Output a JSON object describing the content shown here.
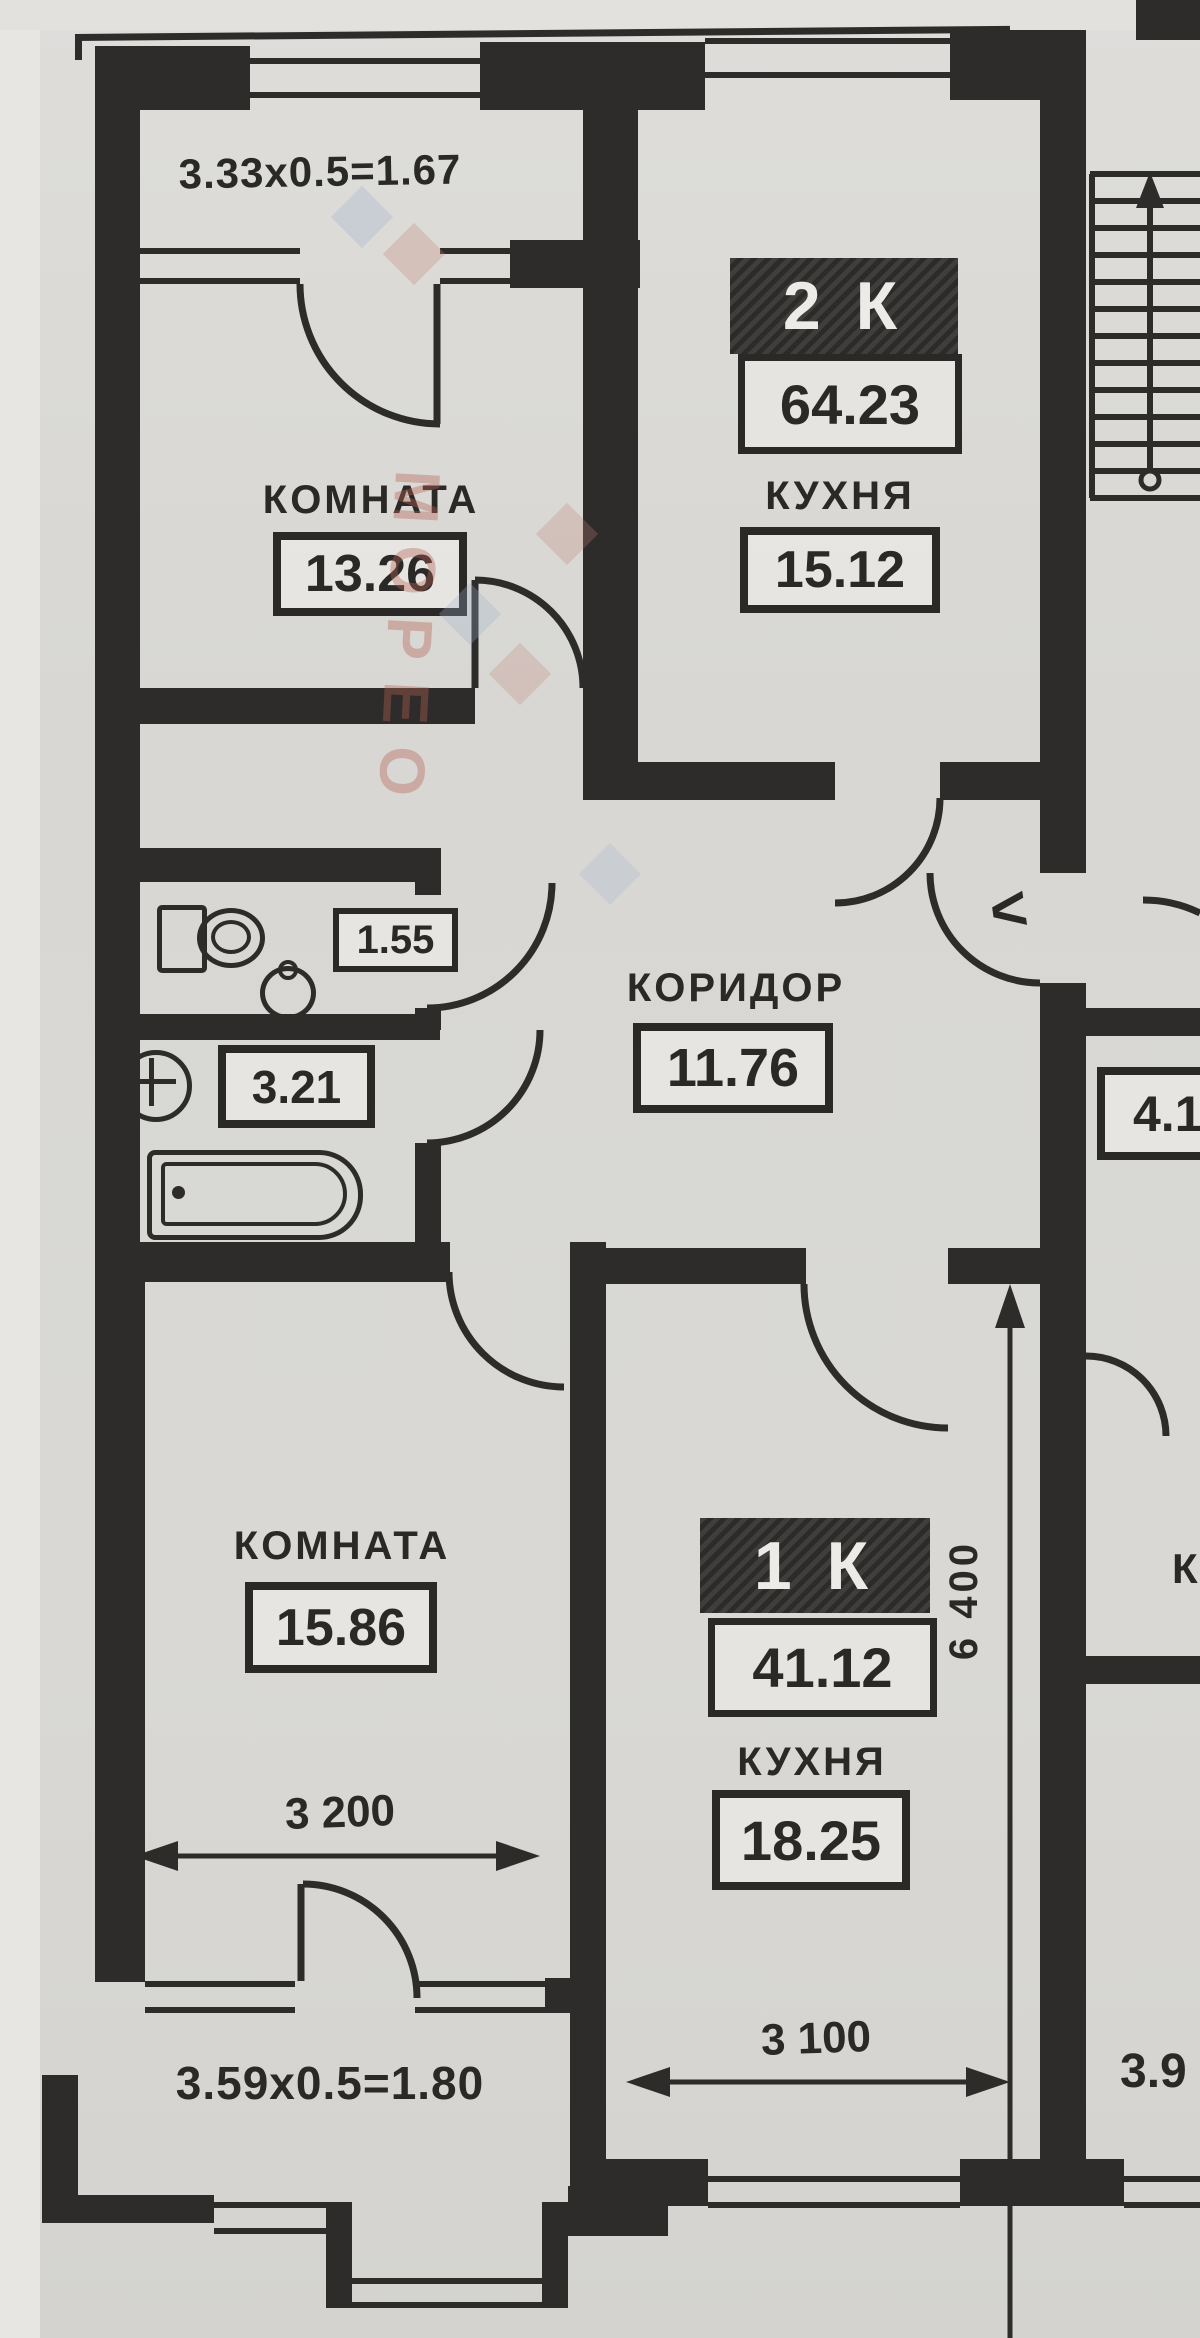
{
  "plan": {
    "watermark": {
      "text": "МОРЕО"
    },
    "colors": {
      "paper": "#d9d8d4",
      "wall": "#2e2c2a",
      "watermark_pink": "#c08376",
      "watermark_blue": "#9fafcc"
    },
    "units": {
      "unit_2k": {
        "badge": "2 К",
        "total_area": "64.23"
      },
      "unit_1k": {
        "badge": "1 К",
        "total_area": "41.12"
      }
    },
    "rooms": {
      "room_top": {
        "label": "КОМНАТА",
        "area": "13.26"
      },
      "kitchen_top": {
        "label": "КУХНЯ",
        "area": "15.12"
      },
      "corridor": {
        "label": "КОРИДОР",
        "area": "11.76"
      },
      "wc": {
        "area": "1.55"
      },
      "bathroom": {
        "area": "3.21"
      },
      "room_bottom": {
        "label": "КОМНАТА",
        "area": "15.86"
      },
      "kitchen_bottom": {
        "label": "КУХНЯ",
        "area": "18.25"
      },
      "neighbor_mid": {
        "area": "4.1"
      },
      "neighbor_bottom": {
        "area": "3.9"
      },
      "neighbor_letter": "К"
    },
    "dimensions": {
      "balcony_top": "3.33x0.5=1.67",
      "balcony_bottom": "3.59x0.5=1.80",
      "room_bottom_width": "3 200",
      "kitchen_bottom_width": "3 100",
      "unit_1k_depth": "6 400"
    },
    "marks": {
      "entrance_chevron": "<"
    }
  }
}
